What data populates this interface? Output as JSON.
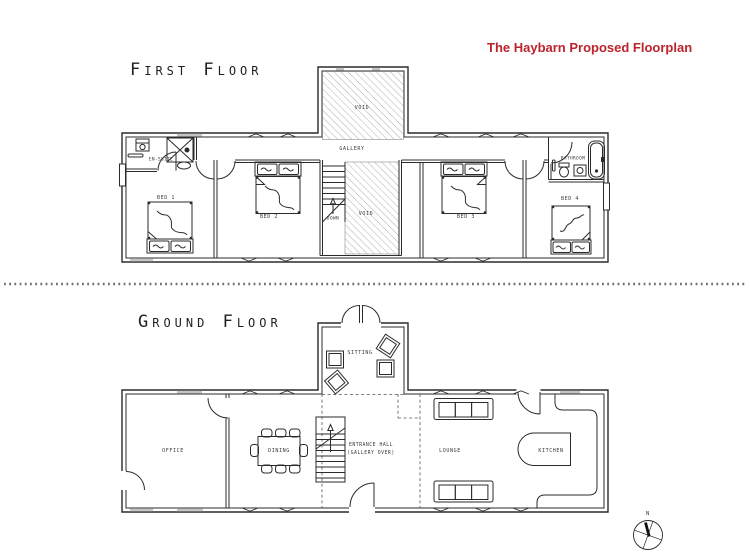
{
  "title": "The Haybarn Proposed Floorplan",
  "first_floor": {
    "label": "First Floor",
    "rooms": {
      "gallery": "Gallery",
      "void_upper": "Void",
      "void_lower": "Void",
      "stairs_direction": "Down",
      "en_suite": "En-Suite",
      "bed1": "Bed 1",
      "bed2": "Bed 2",
      "bed3": "Bed 3",
      "bed4": "Bed 4",
      "bathroom": "Bathroom"
    }
  },
  "ground_floor": {
    "label": "Ground Floor",
    "rooms": {
      "sitting": "Sitting",
      "office": "Office",
      "dining": "Dining",
      "entrance_hall_line1": "Entrance Hall",
      "entrance_hall_line2": "(Gallery Over)",
      "lounge": "Lounge",
      "kitchen": "Kitchen"
    }
  },
  "compass": {
    "north": "N"
  },
  "colors": {
    "title_red": "#bb242c",
    "line": "#2b2b2b",
    "hatch": "#9a9a9a"
  }
}
